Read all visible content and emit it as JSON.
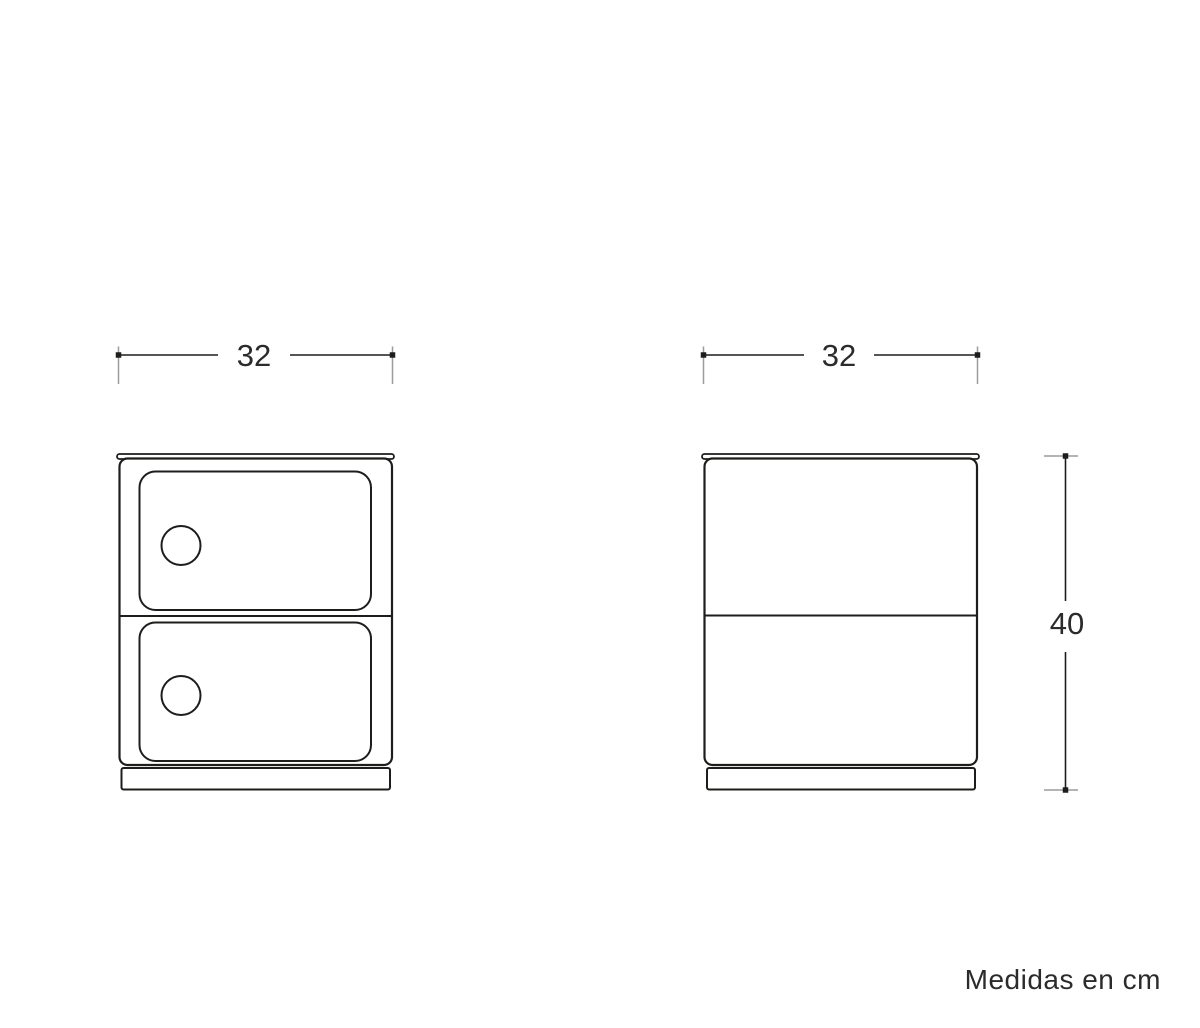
{
  "views": {
    "front": {
      "width_label": "32"
    },
    "side": {
      "width_label": "32",
      "height_label": "40"
    }
  },
  "footer": {
    "units_note": "Medidas en cm"
  },
  "colors": {
    "line": "#1d1d1b",
    "extension": "#9c9c9c",
    "text": "#2b2b2b",
    "background": "#ffffff"
  }
}
